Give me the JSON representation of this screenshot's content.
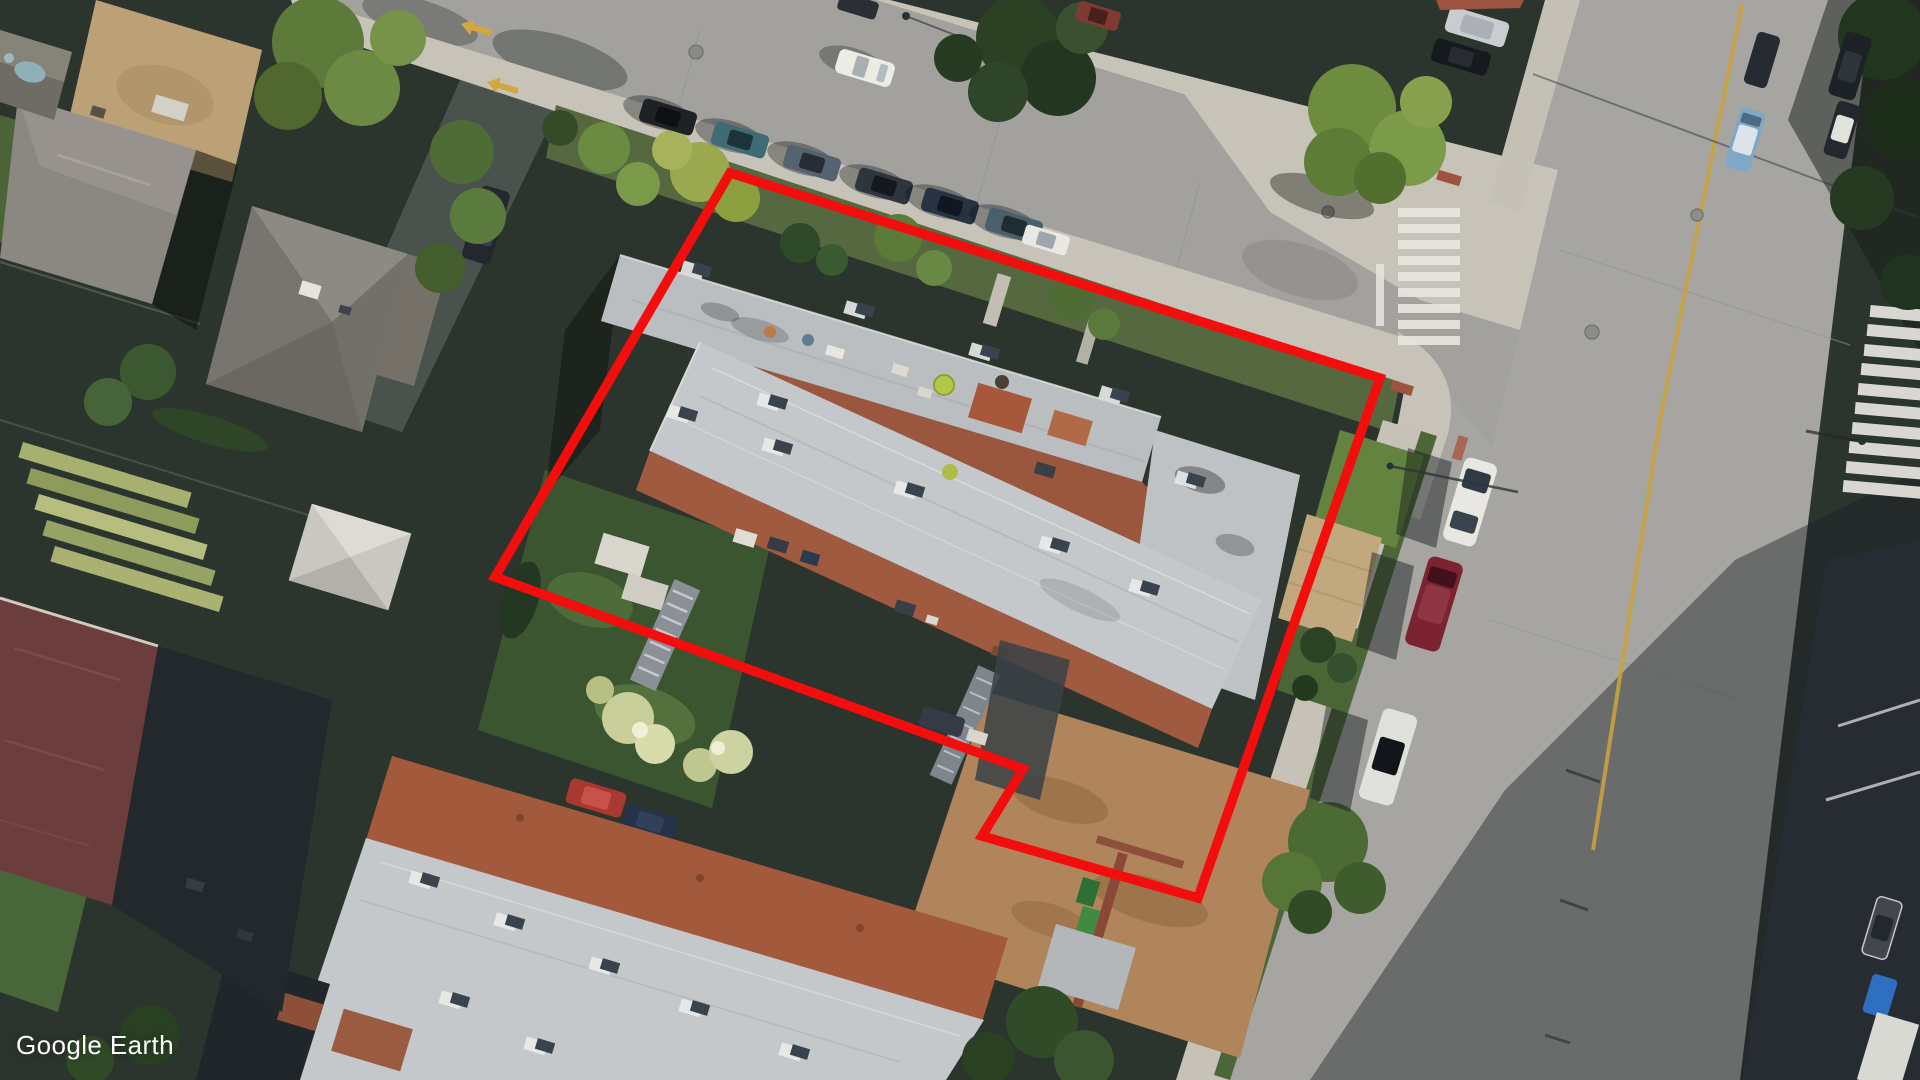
{
  "app": {
    "name": "Google Earth",
    "watermark_text": "Google Earth"
  },
  "imagery": {
    "kind": "oblique-aerial-photograph",
    "visible_features": [
      "street T-intersection with two zebra crosswalks",
      "apartment complex with gray flat roofs and terracotta roof terraces",
      "second apartment building at lower left",
      "detached hip-roof houses at upper left",
      "rows of parallel-parked cars on both streets",
      "street trees, garden beds and rear yards",
      "red property-boundary overlay polygon"
    ]
  },
  "overlay": {
    "property_outline": {
      "shape": "polygon",
      "points": "730,173 1380,378 1198,898 982,836 1023,769 495,577",
      "stroke_color": "#f30d0d",
      "stroke_width": 9.5
    }
  },
  "palette": {
    "road": "#a3a29e",
    "sidewalk": "#c7c3b9",
    "roof_gray": "#c4c8ca",
    "roof_terracotta": "#a05a3f",
    "roof_maroon": "#6b3d3c",
    "grass": "#55683f",
    "tree_dark": "#2c4124",
    "lane_yellow": "#c9a23e",
    "crosswalk_white": "#e7e5df",
    "watermark_white": "#ffffff"
  }
}
